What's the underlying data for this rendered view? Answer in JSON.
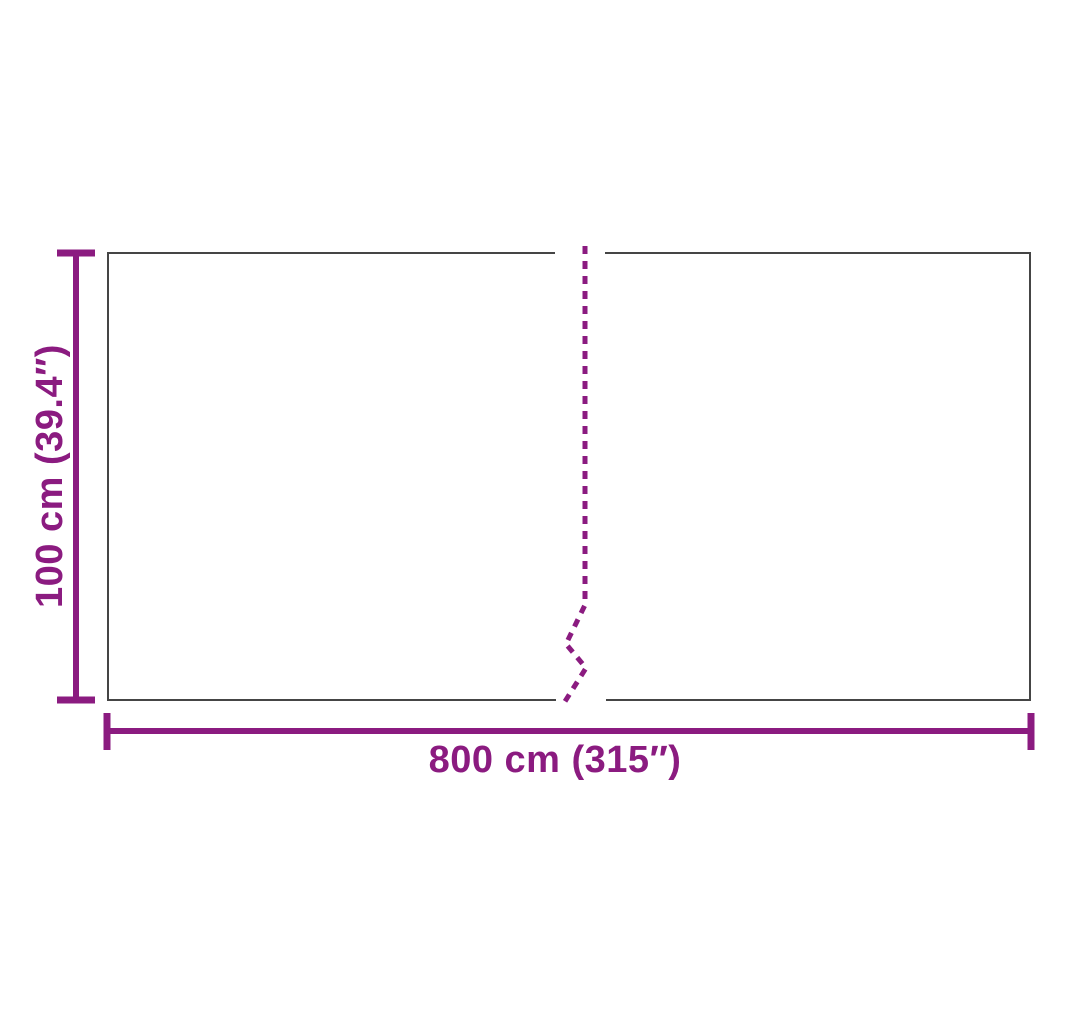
{
  "colors": {
    "accent": "#8B1B80",
    "outline": "#454545",
    "background": "#FFFFFF"
  },
  "labels": {
    "height": "100 cm (39.4″)",
    "width": "800 cm (315″)"
  }
}
